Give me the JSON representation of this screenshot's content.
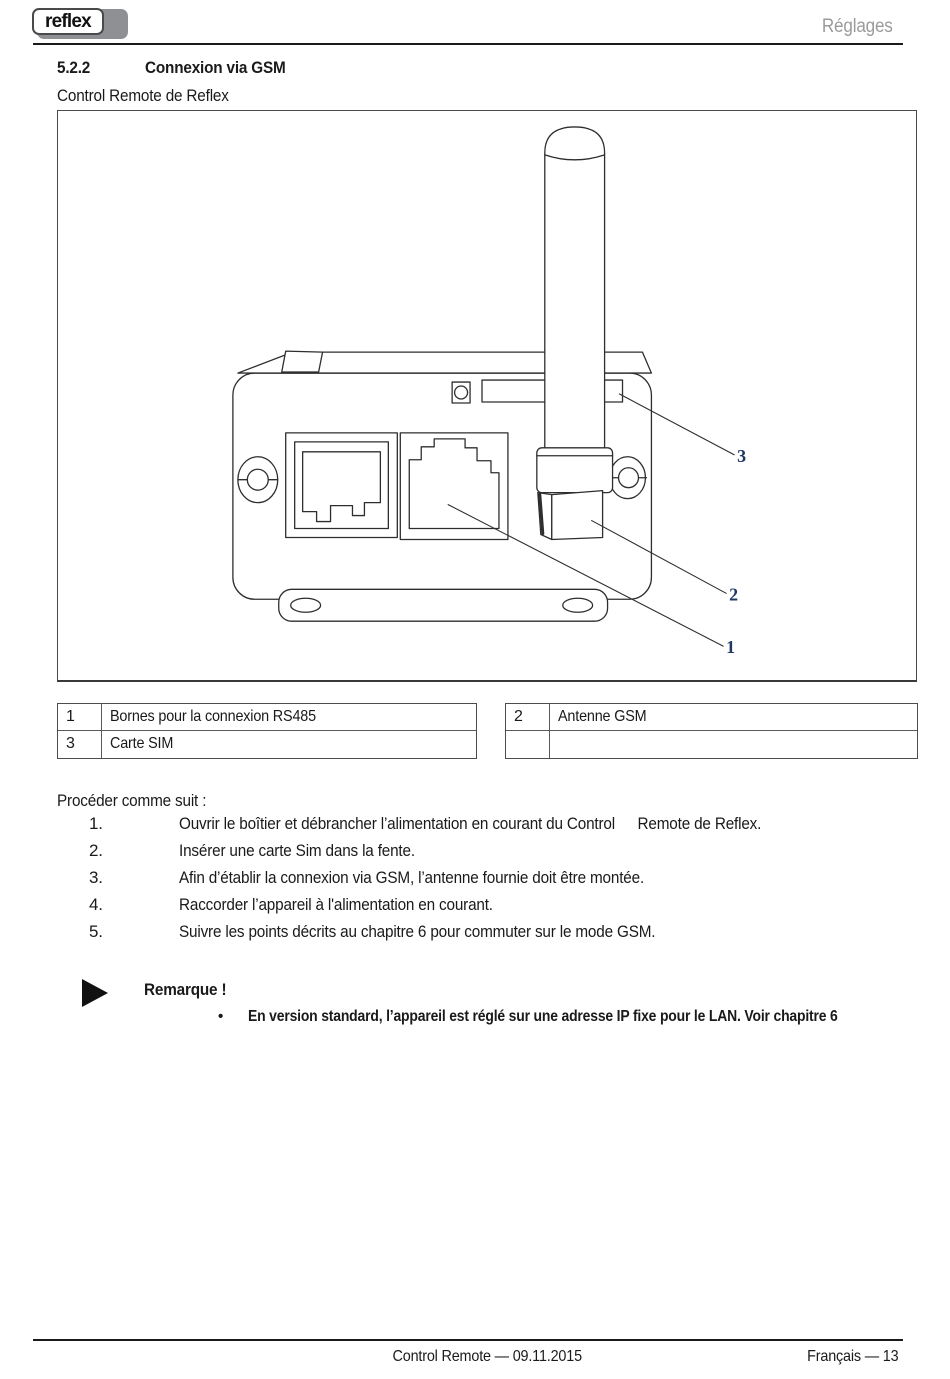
{
  "header": {
    "logo": "reflex",
    "page_section": "Réglages"
  },
  "heading": {
    "number": "5.2.2",
    "title": "Connexion via GSM"
  },
  "subtitle": "Control Remote de Reflex",
  "figure": {
    "callout_1": "1",
    "callout_2": "2",
    "callout_3": "3"
  },
  "legend": {
    "left_rows": [
      {
        "num": "1",
        "label": "Bornes pour la connexion RS485"
      },
      {
        "num": "3",
        "label": "Carte SIM"
      }
    ],
    "right_rows": [
      {
        "num": "2",
        "label": "Antenne GSM"
      },
      {
        "num": "",
        "label": ""
      }
    ]
  },
  "procedure": {
    "intro": "Procéder comme suit :",
    "steps": [
      {
        "num": "1.",
        "text": "Ouvrir le boîtier et débrancher l’alimentation en courant du Control  Remote de Reflex."
      },
      {
        "num": "2.",
        "text": "Insérer une carte Sim dans la fente."
      },
      {
        "num": "3.",
        "text": "Afin d’établir la connexion via GSM, l’antenne fournie doit être montée."
      },
      {
        "num": "4.",
        "text": "Raccorder l’appareil à l'alimentation en courant."
      },
      {
        "num": "5.",
        "text": "Suivre les points décrits au chapitre 6 pour commuter sur le mode GSM."
      }
    ]
  },
  "note": {
    "title": "Remarque !",
    "bullet_glyph": "•",
    "bullet": "En version standard, l’appareil est réglé sur une adresse IP fixe pour le LAN. Voir chapitre 6"
  },
  "footer": {
    "center": "Control Remote — 09.11.2015",
    "right": "Français  — 13"
  },
  "colors": {
    "callout_accent": "#1f3864",
    "muted_header_text": "#9b9b9b"
  }
}
